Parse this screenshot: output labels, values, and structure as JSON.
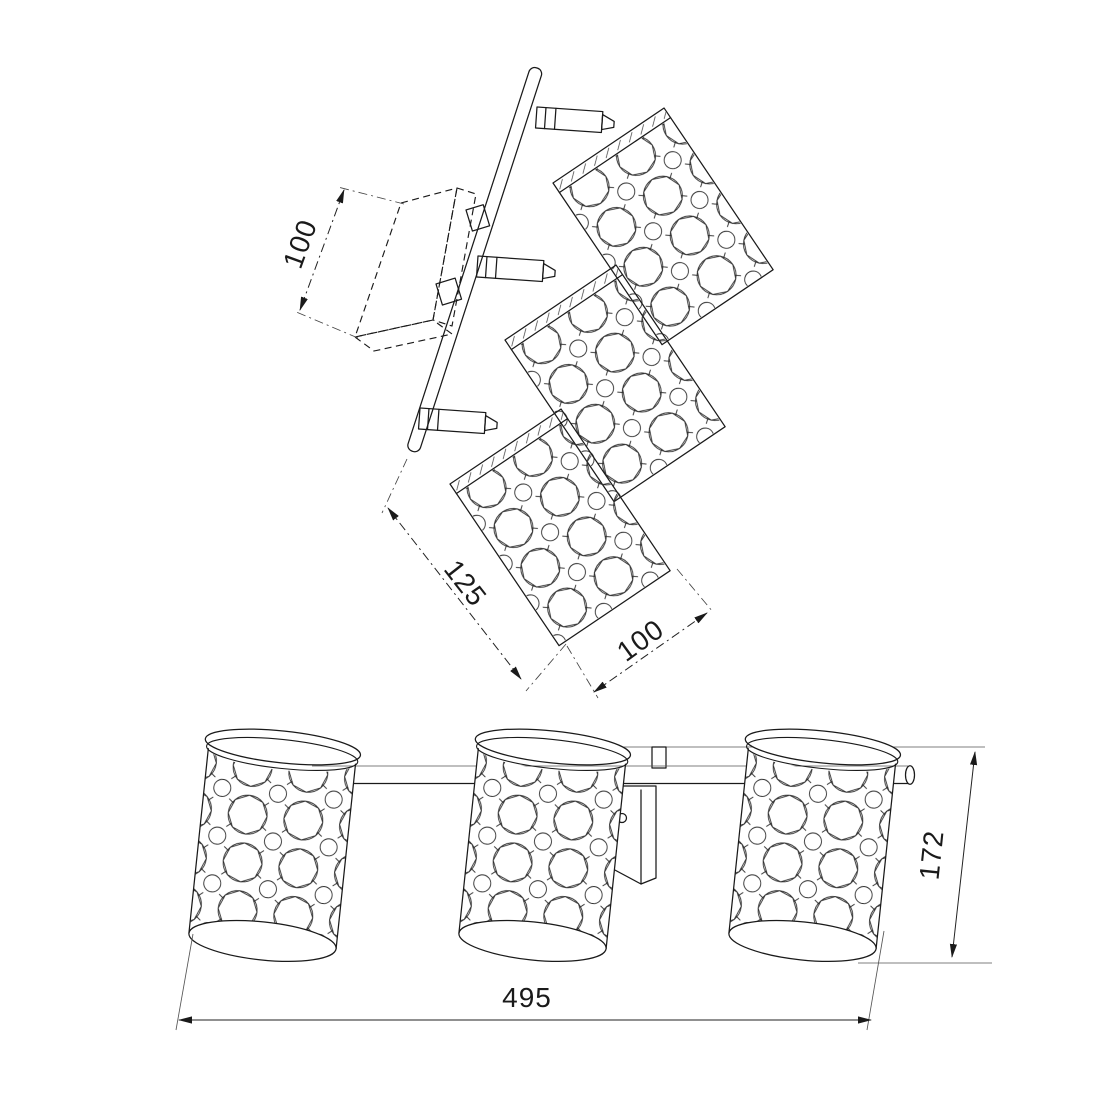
{
  "drawing": {
    "title": "Three-light crystal spot fixture — dimension drawing",
    "views": {
      "top_view": "angled top view with mounting canopy, rod and three square crystal shades",
      "front_view": "front view with three cylindrical crystal shades on a horizontal bar"
    },
    "dimensions": {
      "canopy_depth": "100",
      "shade_length": "125",
      "shade_width": "100",
      "overall_width": "495",
      "overall_height": "172"
    },
    "units": "mm",
    "line_color": "#1a1a1a",
    "background_color": "#ffffff"
  }
}
